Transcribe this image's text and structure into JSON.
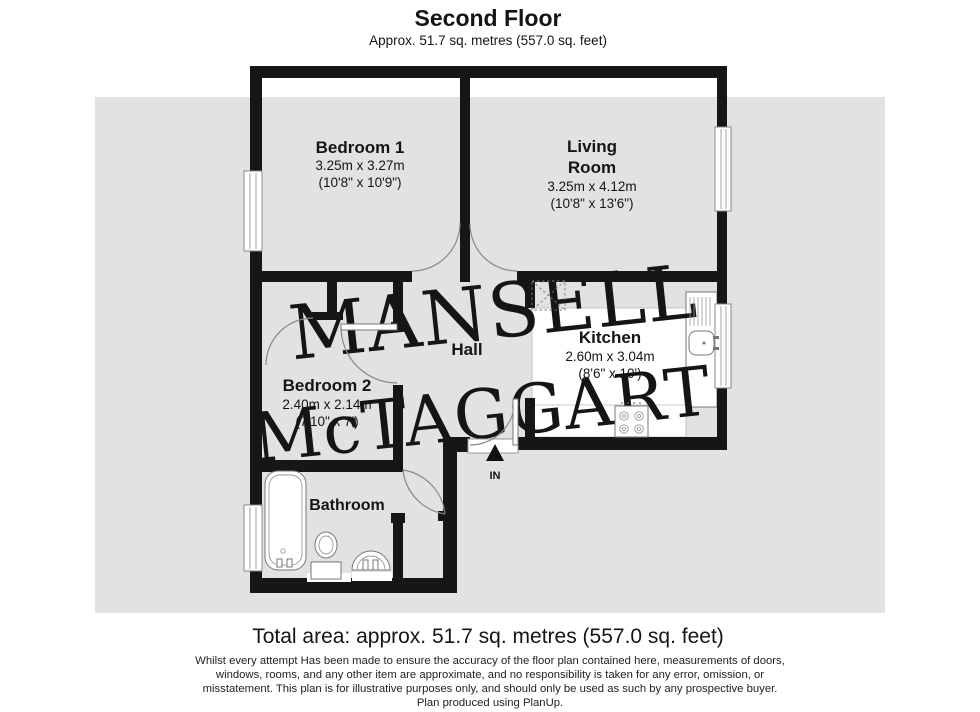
{
  "header": {
    "title": "Second Floor",
    "subtitle": "Approx. 51.7 sq. metres (557.0 sq. feet)"
  },
  "rooms": {
    "bedroom1": {
      "name": "Bedroom 1",
      "metric": "3.25m x 3.27m",
      "imperial": "(10'8\" x 10'9\")"
    },
    "living": {
      "name_lines": [
        "Living",
        "Room"
      ],
      "metric": "3.25m x 4.12m",
      "imperial": "(10'8\" x 13'6\")"
    },
    "kitchen": {
      "name": "Kitchen",
      "metric": "2.60m x 3.04m",
      "imperial": "(8'6\" x 10')"
    },
    "bedroom2": {
      "name": "Bedroom 2",
      "metric": "2.40m x 2.14m",
      "imperial": "(7'10\" x 7')"
    },
    "bathroom": {
      "name": "Bathroom"
    },
    "hall": {
      "name": "Hall"
    }
  },
  "entrance": {
    "label": "IN"
  },
  "watermark": {
    "line1": "MANSELL",
    "line2": "McTAGGART"
  },
  "footer": {
    "total": "Total area: approx. 51.7 sq. metres (557.0 sq. feet)",
    "disclaimer": [
      "Whilst every attempt Has been made to ensure the accuracy of the floor plan contained here, measurements of doors,",
      "windows, rooms, and any other item are approximate, and no responsibility is taken for any error, omission, or",
      "misstatement. This plan is for illustrative purposes only, and should only be used as such by any prospective buyer.",
      "Plan produced using PlanUp."
    ]
  },
  "colors": {
    "wall": "#161616",
    "background_band": "#e2e2e2",
    "watermark": "#ececec"
  }
}
